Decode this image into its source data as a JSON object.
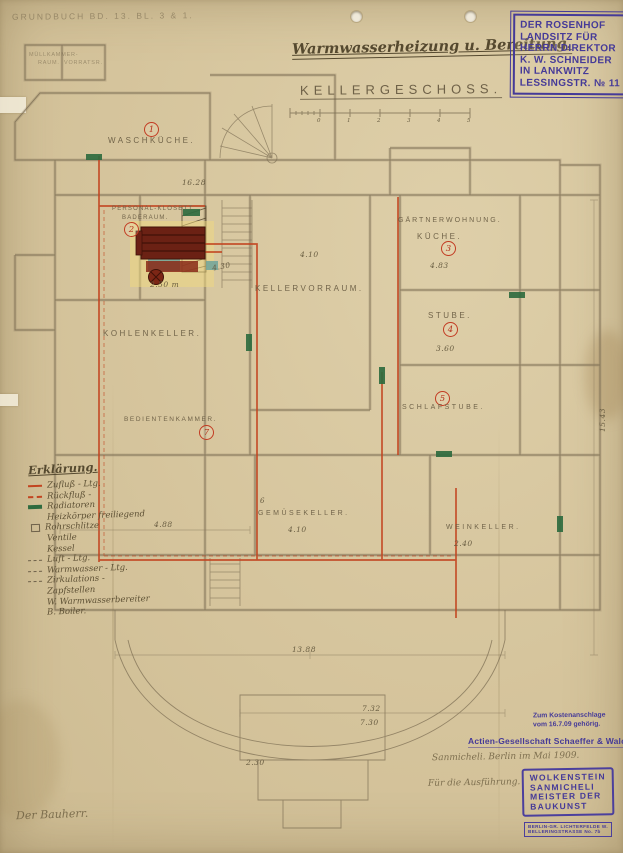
{
  "colors": {
    "paper": "#d6c59d",
    "pencil": "#6e614a",
    "pipe_red": "#c2441f",
    "radiator_green": "#2f6b3f",
    "stamp_purple": "#453a98",
    "boiler_maroon": "#6b2114"
  },
  "header": {
    "registry_note": "GRUNDBUCH BD. 13. BL. 3 & 1.",
    "title": "Warmwasserheizung u. Bereitung.",
    "owner_stamp_lines": [
      "DER ROSENHOF",
      "LANDSITZ FÜR",
      "HERRN DIREKTOR",
      "K. W. SCHNEIDER",
      "IN LANKWITZ",
      "LESSINGSTR. № 11"
    ]
  },
  "plan": {
    "floor_label": "KELLERGESCHOSS.",
    "scale_ticks": [
      "0",
      "1",
      "2",
      "3",
      "4",
      "5"
    ],
    "rooms": [
      {
        "number": "1",
        "label": "WASCHKÜCHE."
      },
      {
        "number": "2",
        "label": "PERSONAL-KLOSETT",
        "label2": "BADERAUM."
      },
      {
        "number": "3",
        "area": "GÄRTNERWOHNUNG.",
        "label": "KÜCHE.",
        "dim": "4.83"
      },
      {
        "number": "4",
        "label": "STUBE.",
        "dim": "3.60"
      },
      {
        "number": "5",
        "label": "SCHLAFSTUBE."
      },
      {
        "number": "6",
        "label": "GEMÜSEKELLER.",
        "dim": "4.10"
      },
      {
        "number": "7",
        "label": "BEDIENTENKAMMER."
      },
      {
        "label": "KOHLENKELLER."
      },
      {
        "label": "KELLERVORRAUM."
      },
      {
        "label": "WEINKELLER.",
        "dim": "2.40"
      },
      {
        "label": "MÜLLKAMMER-",
        "label2": "RAUM."
      },
      {
        "label": "VORRATSR."
      }
    ],
    "dims": [
      "16.28",
      "2.50 m",
      "4.30",
      "4.10",
      "13.88",
      "7.32",
      "7.30",
      "15.43",
      "2.30",
      "4.88"
    ]
  },
  "legend": {
    "title": "Erklärung.",
    "entries": [
      {
        "label": "Zufluß - Ltg."
      },
      {
        "label": "Rückfluß -"
      },
      {
        "label": "Radiatoren"
      },
      {
        "label": "Heizkörper freiliegend"
      },
      {
        "label": "Rohrschlitze"
      },
      {
        "label": "Ventile"
      },
      {
        "label": "Kessel"
      },
      {
        "label": "Luft - Ltg."
      },
      {
        "label": "Warmwasser - Ltg."
      },
      {
        "label": "Zirkulations -"
      },
      {
        "label": "Zapfstellen"
      },
      {
        "label": "W. Warmwasserbereiter"
      },
      {
        "label": "B. Boiler."
      }
    ]
  },
  "footer": {
    "cost_note_line1": "Zum Kostenanschlage",
    "cost_note_line2": "vom 16.7.09 gehörig.",
    "company": "Actien-Gesellschaft Schaeffer & Walcker.",
    "pencil_note1": "Sanmicheli.  Berlin im Mai 1909.",
    "pencil_note2": "Für die Ausführung.",
    "architect_stamp_lines": [
      "WOLKENSTEIN",
      "SANMICHELI",
      "MEISTER DER",
      "BAUKUNST"
    ],
    "address_stamp_lines": [
      "BERLIN-GR. LICHTERFELDE W.",
      "BELLERINGSTRASSE No. 7b"
    ],
    "client_label": "Der Bauherr."
  }
}
